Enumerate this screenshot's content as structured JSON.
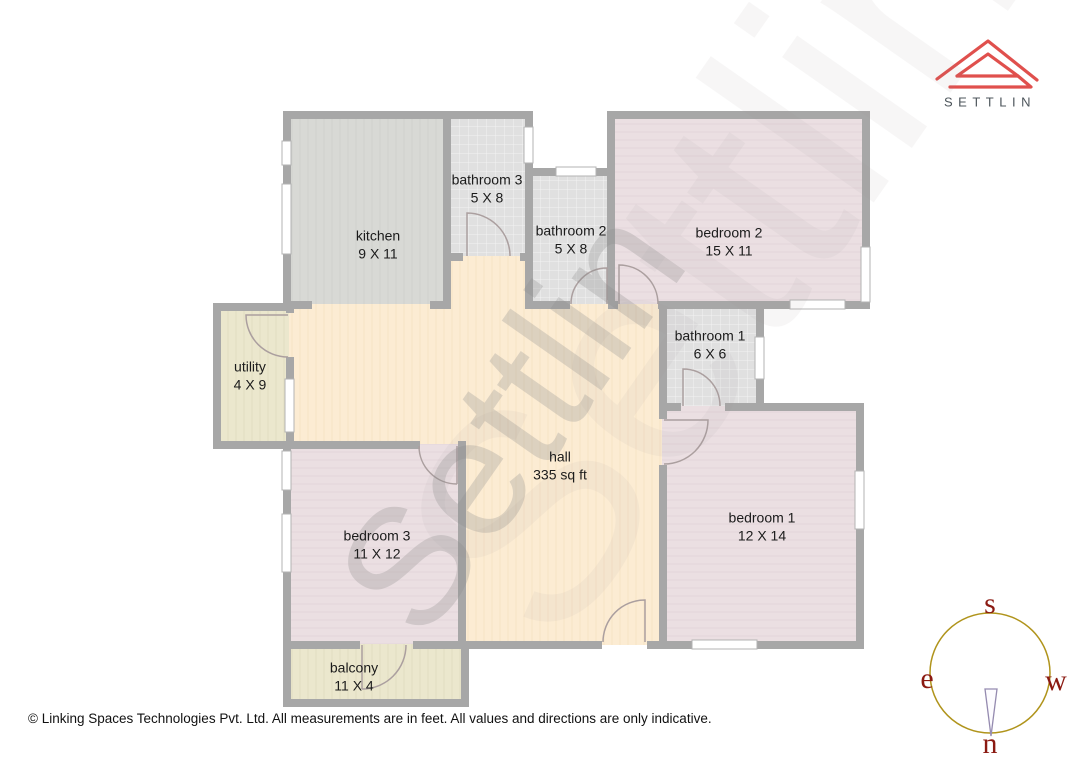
{
  "brand": {
    "name": "SETTLIN",
    "logo_color": "#e0504d",
    "text_color": "#4d555b"
  },
  "plan": {
    "watermark": "Settlin",
    "rooms": [
      {
        "id": "kitchen",
        "name": "kitchen",
        "dims": "9 X 11"
      },
      {
        "id": "bathroom3",
        "name": "bathroom 3",
        "dims": "5 X 8"
      },
      {
        "id": "bathroom2",
        "name": "bathroom 2",
        "dims": "5 X 8"
      },
      {
        "id": "bedroom2",
        "name": "bedroom 2",
        "dims": "15 X 11"
      },
      {
        "id": "bathroom1",
        "name": "bathroom 1",
        "dims": "6 X 6"
      },
      {
        "id": "utility",
        "name": "utility",
        "dims": "4 X 9"
      },
      {
        "id": "hall",
        "name": "hall",
        "dims": "335 sq ft"
      },
      {
        "id": "bedroom3",
        "name": "bedroom 3",
        "dims": "11 X 12"
      },
      {
        "id": "bedroom1",
        "name": "bedroom 1",
        "dims": "12 X 14"
      },
      {
        "id": "balcony",
        "name": "balcony",
        "dims": "11 X 4"
      }
    ],
    "colors": {
      "wall": "#a7a7a7",
      "hall_fill": "#fcecd3",
      "bedroom_fill": "#ebdfe2",
      "kitchen_fill": "#d8d9d5",
      "bathroom_fill": "#e0e0e0",
      "utility_balcony_fill": "#ebe7cd"
    }
  },
  "compass": {
    "south": "s",
    "east": "e",
    "west": "w",
    "north": "n",
    "ring_color": "#b0941c",
    "letter_color": "#8b1a12"
  },
  "footer": {
    "copyright": "© Linking Spaces Technologies Pvt. Ltd. All measurements are in feet. All values and directions are only indicative."
  }
}
